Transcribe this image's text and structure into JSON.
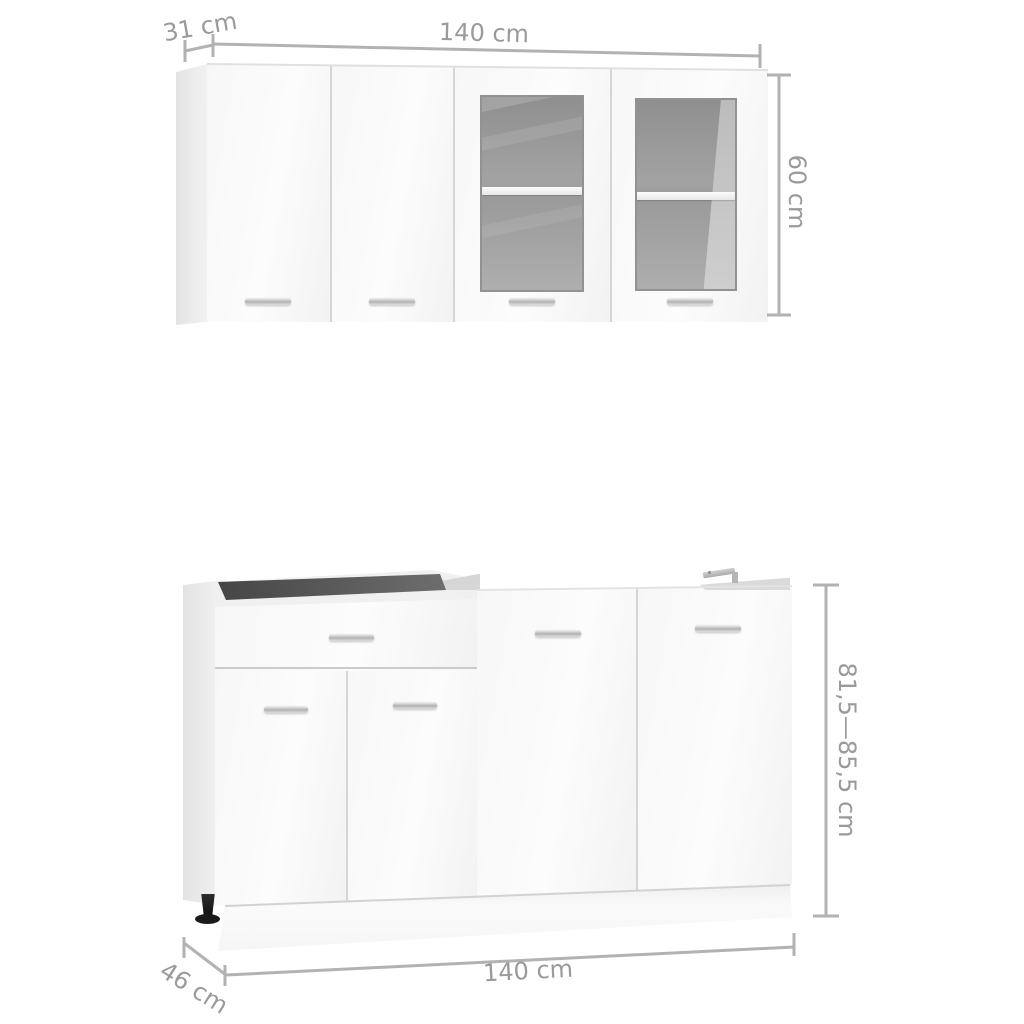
{
  "dimensions": {
    "wall_cabinet": {
      "depth_label": "31 cm",
      "width_label": "140 cm",
      "height_label": "60 cm"
    },
    "base_cabinet": {
      "height_label": "81,5—85,5 cm",
      "depth_label": "46 cm",
      "width_label": "140 cm"
    }
  },
  "colors": {
    "background": "#ffffff",
    "dimension_line": "#b2b2b2",
    "dimension_text": "#9a9a9a",
    "cabinet_face": "#f7f7f7",
    "cabinet_side": "#e6e6e6",
    "glass": "#9b9b9b",
    "handle_chrome": "#c9c9c9",
    "foot_black": "#1c1c1c"
  }
}
